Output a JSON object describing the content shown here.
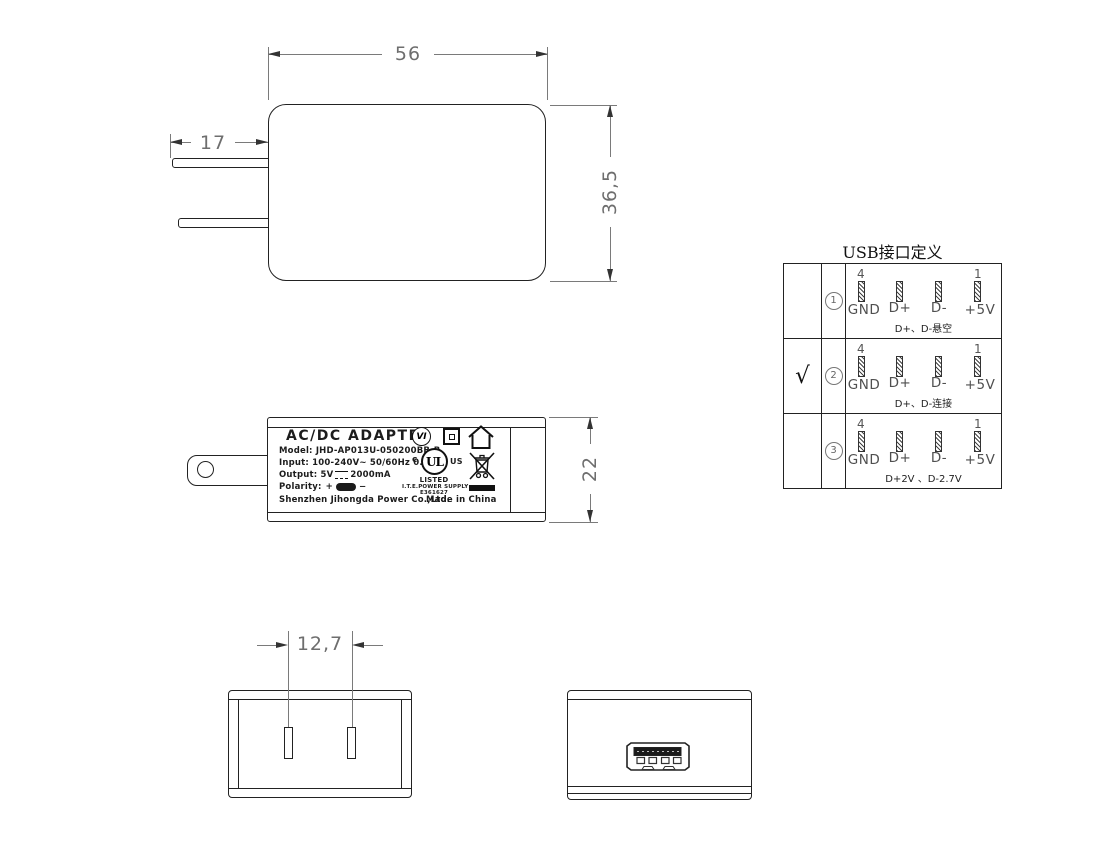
{
  "front_view": {
    "dim_width": "56",
    "dim_prong": "17",
    "dim_height": "36,5"
  },
  "side_view": {
    "dim_height": "22",
    "label": {
      "title": "AC/DC  ADAPTER",
      "model": "Model: JHD-AP013U-050200BB-B",
      "input": "Input: 100-240V~  50/60Hz  0.35A",
      "output_prefix": "Output: 5V",
      "output_suffix": "2000mA",
      "polarity": "Polarity:",
      "plus": "+",
      "minus": "−",
      "company": "Shenzhen Jihongda Power Co.,Ltd.",
      "made_in": "Made in China",
      "efficiency": "VI",
      "ul_logo": "UL",
      "ul_c": "c",
      "ul_us": "US",
      "ul_listed": "LISTED",
      "ul_line": "I.T.E.POWER SUPPLY",
      "ul_file": "E361627"
    }
  },
  "bottom_view": {
    "dim_pin_spacing": "12,7"
  },
  "usb_table": {
    "title": "USB接口定义",
    "pin_num_first": "4",
    "pin_num_last": "1",
    "pin_labels": [
      "GND",
      "D+",
      "D-",
      "+5V"
    ],
    "rows": [
      {
        "check": "",
        "index": "1",
        "note": "D+、D-悬空"
      },
      {
        "check": "√",
        "index": "2",
        "note": "D+、D-连接"
      },
      {
        "check": "",
        "index": "3",
        "note": "D+2V 、D-2.7V"
      }
    ]
  }
}
